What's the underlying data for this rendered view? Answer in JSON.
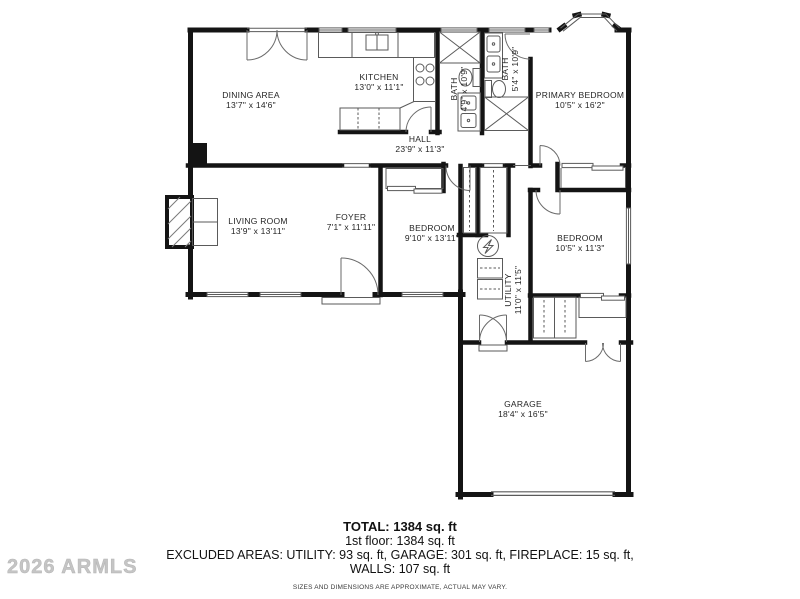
{
  "watermark": "2026 ARMLS",
  "rooms": [
    {
      "name": "DINING AREA",
      "dims": "13'7\" x 14'6\""
    },
    {
      "name": "KITCHEN",
      "dims": "13'0\" x 11'1\""
    },
    {
      "name": "BATH",
      "dims": "4'9\" x 10'9\""
    },
    {
      "name": "BATH",
      "dims": "5'4\" x 10'9\""
    },
    {
      "name": "PRIMARY BEDROOM",
      "dims": "10'5\" x 16'2\""
    },
    {
      "name": "HALL",
      "dims": "23'9\" x 11'3\""
    },
    {
      "name": "LIVING ROOM",
      "dims": "13'9\" x 13'11\""
    },
    {
      "name": "FOYER",
      "dims": "7'1\" x 11'11\""
    },
    {
      "name": "BEDROOM",
      "dims": "9'10\" x 13'11\""
    },
    {
      "name": "BEDROOM",
      "dims": "10'5\" x 11'3\""
    },
    {
      "name": "UTILITY",
      "dims": "11'0\" x 11'5\""
    },
    {
      "name": "GARAGE",
      "dims": "18'4\" x 16'5\""
    }
  ],
  "footer": {
    "total": "TOTAL: 1384 sq. ft",
    "floor": "1st floor: 1384 sq. ft",
    "excluded": "EXCLUDED AREAS: UTILITY: 93 sq. ft, GARAGE: 301 sq. ft, FIREPLACE: 15 sq. ft,",
    "walls": "WALLS: 107 sq. ft",
    "disclaimer": "SIZES AND DIMENSIONS ARE APPROXIMATE, ACTUAL MAY VARY."
  },
  "colors": {
    "wall": "#141414",
    "thin_line": "#5a5a5a",
    "text": "#252525",
    "watermark": "#c5c5c5"
  }
}
